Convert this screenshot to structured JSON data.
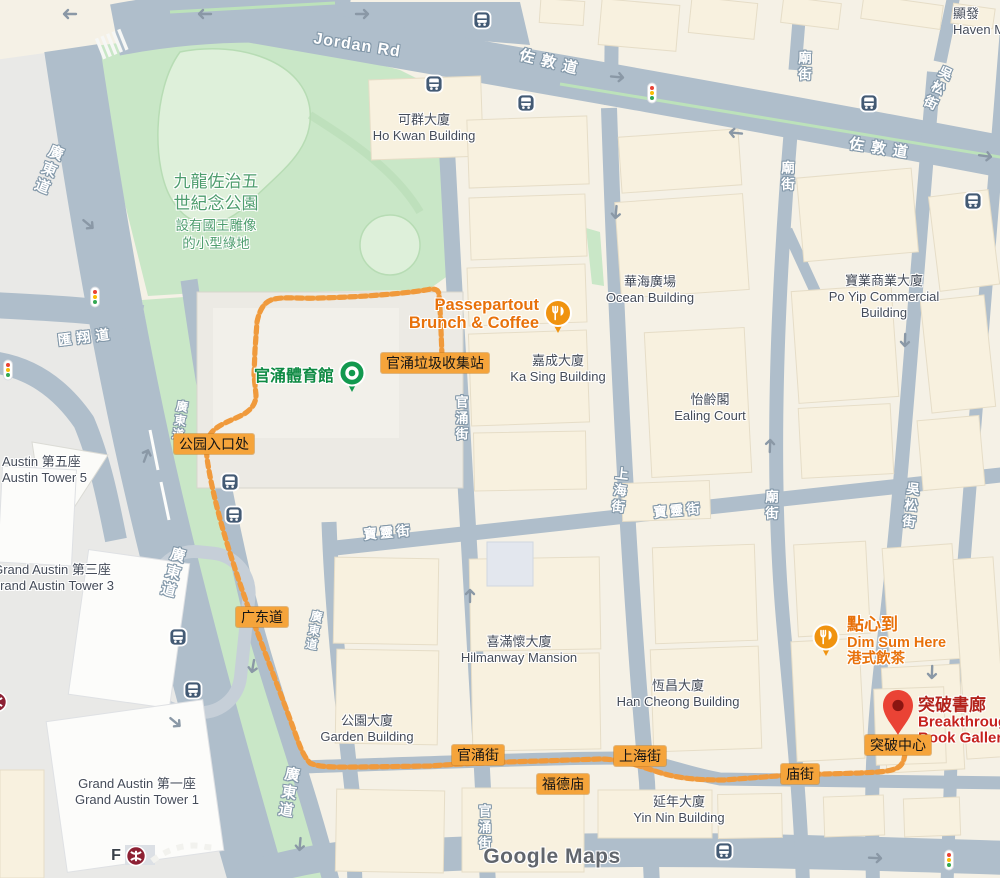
{
  "watermark": "Google Maps",
  "theme": {
    "road_fill": "#AFBECB",
    "park_fill": "#C9E7C7",
    "route_color": "#F09A3C",
    "badge_bg": "#F5A43B",
    "poi_orange": "#E8710A",
    "poi_red": "#C5221F",
    "pin_red": "#EA4335",
    "building_fill": "#F8F1DF",
    "label_gray": "#454C59",
    "park_text_green": "#4E9D6E",
    "sports_green": "#0E8A43",
    "bus_icon_bg": "#435A74",
    "mtr_red": "#8D2134"
  },
  "park": {
    "name1": "九龍佐治五",
    "name2": "世紀念公園",
    "desc1": "設有國王雕像",
    "desc2": "的小型綠地"
  },
  "sports_centre": "官涌體育館",
  "road_labels": [
    "Jordan Rd",
    "佐敦道",
    "佐敦道",
    "廣東道",
    "廣東道",
    "廣東道",
    "廣東道",
    "廣東道",
    "匯翔道",
    "官涌街",
    "官涌街",
    "上海街",
    "廟街",
    "廟街",
    "廟街",
    "吳松街",
    "吳松街",
    "寶靈街",
    "寶靈街"
  ],
  "buildings": [
    {
      "zh": "可群大廈",
      "en": "Ho Kwan Building"
    },
    {
      "zh": "華海廣場",
      "en": "Ocean Building"
    },
    {
      "zh": "寶業商業大廈",
      "en": "Po Yip Commercial Building"
    },
    {
      "zh": "嘉成大廈",
      "en": "Ka Sing Building"
    },
    {
      "zh": "怡齡閣",
      "en": "Ealing Court"
    },
    {
      "zh": "喜滿懷大廈",
      "en": "Hilmanway Mansion"
    },
    {
      "zh": "恆昌大廈",
      "en": "Han Cheong Building"
    },
    {
      "zh": "公園大廈",
      "en": "Garden Building"
    },
    {
      "zh": "延年大廈",
      "en": "Yin Nin Building"
    },
    {
      "zh": "Grand Austin 第三座",
      "en": "Grand Austin Tower 3"
    },
    {
      "zh": "Grand Austin 第一座",
      "en": "Grand Austin Tower 1"
    },
    {
      "zh": "Austin 第五座",
      "en": "Austin Tower 5"
    },
    {
      "zh": "顯發",
      "en": "Haven M"
    }
  ],
  "pois": {
    "passepartout": {
      "line1": "Passepartout",
      "line2": "Brunch & Coffee"
    },
    "dim_sum": {
      "line1": "點心到",
      "line2": "Dim Sum Here",
      "line3": "港式飲茶"
    },
    "breakthrough": {
      "line1": "突破書廊",
      "line2": "Breakthrough",
      "line3": "Book Gallery"
    }
  },
  "badges": [
    {
      "label": "官涌垃圾收集站"
    },
    {
      "label": "公园入口处"
    },
    {
      "label": "广东道"
    },
    {
      "label": "官涌街"
    },
    {
      "label": "福德庙"
    },
    {
      "label": "上海街"
    },
    {
      "label": "庙街"
    },
    {
      "label": "突破中心"
    }
  ],
  "mtr_exit": "F"
}
